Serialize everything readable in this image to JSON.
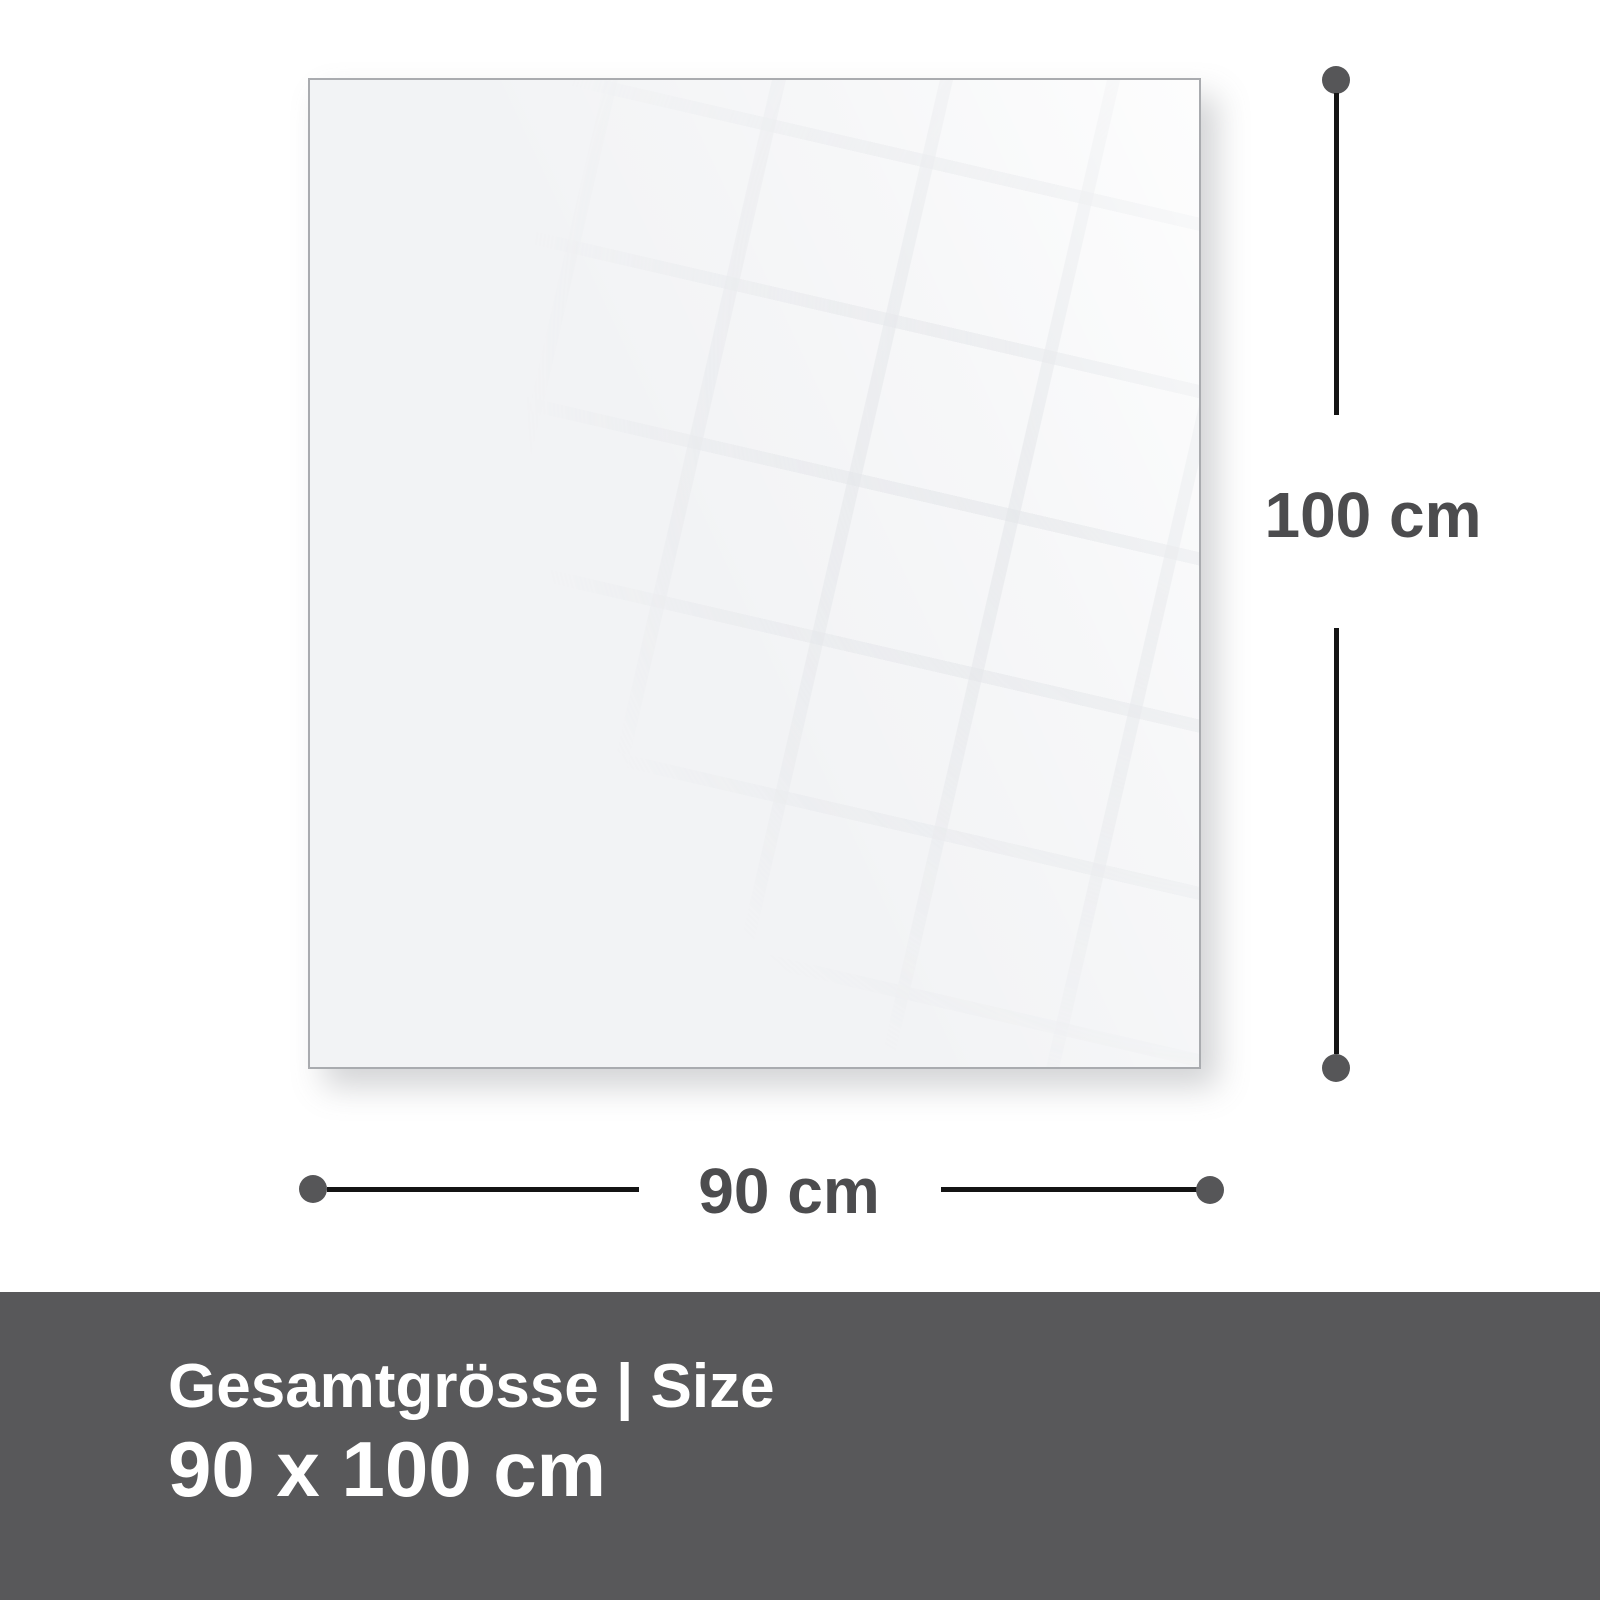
{
  "panel": {
    "description": "glass panel preview"
  },
  "dimensions": {
    "height_label": "100 cm",
    "width_label": "90 cm"
  },
  "footer": {
    "title": "Gesamtgrösse | Size",
    "size_value": "90 x 100 cm"
  },
  "colors": {
    "background": "#ffffff",
    "panel_fill": "#f2f3f5",
    "panel_border": "#a9abaf",
    "dimension_line": "#141414",
    "dimension_dot": "#565658",
    "dimension_label_text": "#4c4c4e",
    "footer_background": "#58585a",
    "footer_text": "#ffffff"
  }
}
